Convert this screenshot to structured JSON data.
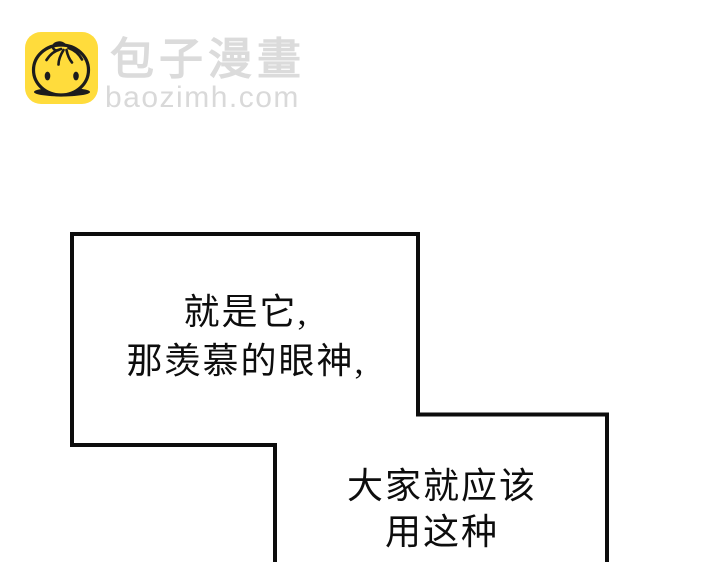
{
  "page": {
    "background_color": "#ffffff"
  },
  "watermark": {
    "brand_name": "包子漫畫",
    "domain": "baozimh.com",
    "icon_name": "baozi-bun-icon",
    "icon_bg_color": "#FFDC3C",
    "icon_line_color": "#1c1c1c",
    "text_color": "#DBDBDB"
  },
  "speech": {
    "border_color": "#0d0d0d",
    "fill_color": "#ffffff",
    "bubble1": {
      "lines": [
        "就是它,",
        "那羡慕的眼神,"
      ]
    },
    "bubble2": {
      "lines": [
        "大家就应该",
        "用这种"
      ]
    }
  }
}
